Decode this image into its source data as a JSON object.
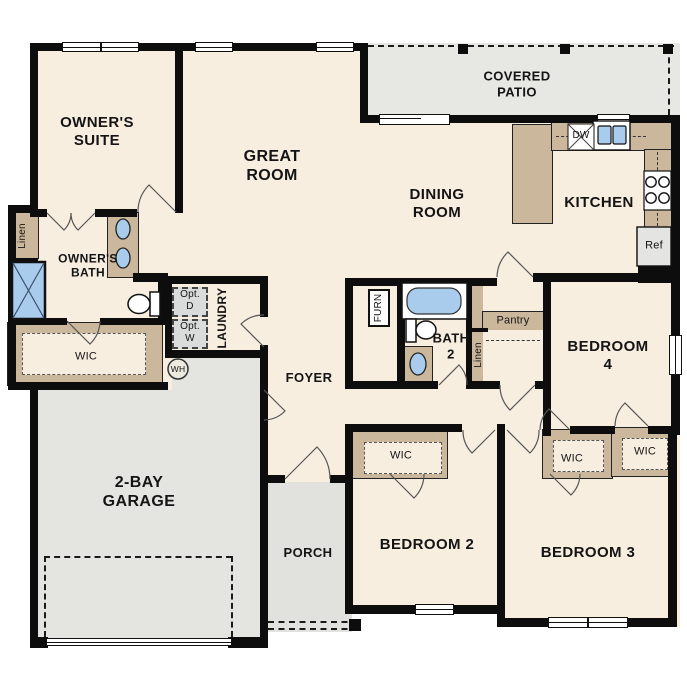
{
  "plan": {
    "rooms": {
      "owners_suite": "OWNER'S\nSUITE",
      "great_room": "GREAT\nROOM",
      "covered_patio": "COVERED\nPATIO",
      "dining_room": "DINING\nROOM",
      "kitchen": "KITCHEN",
      "owners_bath": "OWNER'S\nBATH",
      "laundry": "LAUNDRY",
      "foyer": "FOYER",
      "garage": "2-BAY\nGARAGE",
      "porch": "PORCH",
      "bath2": "BATH\n2",
      "bedroom2": "BEDROOM 2",
      "bedroom3": "BEDROOM 3",
      "bedroom4": "BEDROOM 4"
    },
    "closets": {
      "linen_owner": "Linen",
      "linen_hall": "Linen",
      "wic_owner": "WIC",
      "wic_bedroom2": "WIC",
      "wic_bedroom3": "WIC",
      "wic_bedroom4": "WIC",
      "pantry": "Pantry"
    },
    "appliances": {
      "dishwasher": "DW",
      "refrigerator": "Ref",
      "water_heater": "WH",
      "furnace": "FURN",
      "optional_dryer": "Opt.\nD",
      "optional_washer": "Opt.\nW"
    },
    "palette": {
      "floor": "#f7eee0",
      "wall": "#0d0d0d",
      "casework": "#cbb79b",
      "concrete": "#e4e4e1",
      "fixture_blue": "#a9cbec",
      "optional_appliance": "#d9dcda"
    }
  }
}
